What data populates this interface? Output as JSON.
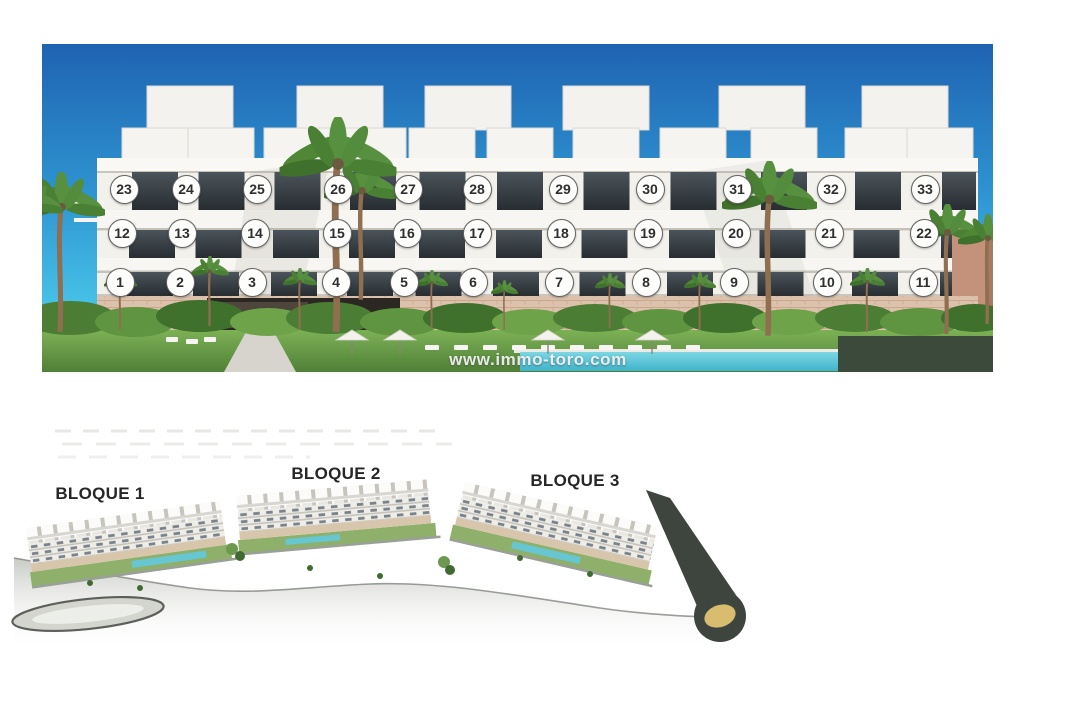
{
  "canvas": {
    "width": 1080,
    "height": 720,
    "background": "#ffffff"
  },
  "elevation_photo": {
    "region": {
      "x": 42,
      "y": 44,
      "width": 951,
      "height": 328
    },
    "watermark": "www.immo-toro.com",
    "marker_diameter": 29,
    "unit_markers": [
      {
        "n": 1,
        "x": 120,
        "y": 282
      },
      {
        "n": 2,
        "x": 180,
        "y": 282
      },
      {
        "n": 3,
        "x": 252,
        "y": 282
      },
      {
        "n": 4,
        "x": 336,
        "y": 282
      },
      {
        "n": 5,
        "x": 404,
        "y": 282
      },
      {
        "n": 6,
        "x": 473,
        "y": 282
      },
      {
        "n": 7,
        "x": 559,
        "y": 282
      },
      {
        "n": 8,
        "x": 646,
        "y": 282
      },
      {
        "n": 9,
        "x": 734,
        "y": 282
      },
      {
        "n": 10,
        "x": 827,
        "y": 282
      },
      {
        "n": 11,
        "x": 923,
        "y": 282
      },
      {
        "n": 12,
        "x": 122,
        "y": 233
      },
      {
        "n": 13,
        "x": 182,
        "y": 233
      },
      {
        "n": 14,
        "x": 255,
        "y": 233
      },
      {
        "n": 15,
        "x": 337,
        "y": 233
      },
      {
        "n": 16,
        "x": 407,
        "y": 233
      },
      {
        "n": 17,
        "x": 477,
        "y": 233
      },
      {
        "n": 18,
        "x": 561,
        "y": 233
      },
      {
        "n": 19,
        "x": 648,
        "y": 233
      },
      {
        "n": 20,
        "x": 736,
        "y": 233
      },
      {
        "n": 21,
        "x": 829,
        "y": 233
      },
      {
        "n": 22,
        "x": 924,
        "y": 233
      },
      {
        "n": 23,
        "x": 124,
        "y": 189
      },
      {
        "n": 24,
        "x": 186,
        "y": 189
      },
      {
        "n": 25,
        "x": 257,
        "y": 189
      },
      {
        "n": 26,
        "x": 338,
        "y": 189
      },
      {
        "n": 27,
        "x": 408,
        "y": 189
      },
      {
        "n": 28,
        "x": 477,
        "y": 189
      },
      {
        "n": 29,
        "x": 563,
        "y": 189
      },
      {
        "n": 30,
        "x": 650,
        "y": 189
      },
      {
        "n": 31,
        "x": 737,
        "y": 189
      },
      {
        "n": 32,
        "x": 831,
        "y": 189
      },
      {
        "n": 33,
        "x": 925,
        "y": 189
      }
    ]
  },
  "site_plan": {
    "region": {
      "x": 0,
      "y": 415,
      "width": 790,
      "height": 260
    },
    "block_labels": [
      {
        "label": "BLOQUE 1",
        "x": 100,
        "y": 494
      },
      {
        "label": "BLOQUE 2",
        "x": 336,
        "y": 474
      },
      {
        "label": "BLOQUE 3",
        "x": 575,
        "y": 481
      }
    ]
  },
  "colors": {
    "sky_top": "#1f63b2",
    "sky_bottom": "#55cdee",
    "facade": "#f3f1ec",
    "window": "#2f363b",
    "base_brick": "#dcc2ad",
    "lawn": "#6fa34a",
    "pool": "#55c4d6",
    "hedge": "#3b4a3b",
    "road_dark": "#3e453e",
    "roundabout_center": "#d9bd6e",
    "marker_border": "#636363",
    "marker_text": "#2f2f2f",
    "label_text": "#262626"
  }
}
